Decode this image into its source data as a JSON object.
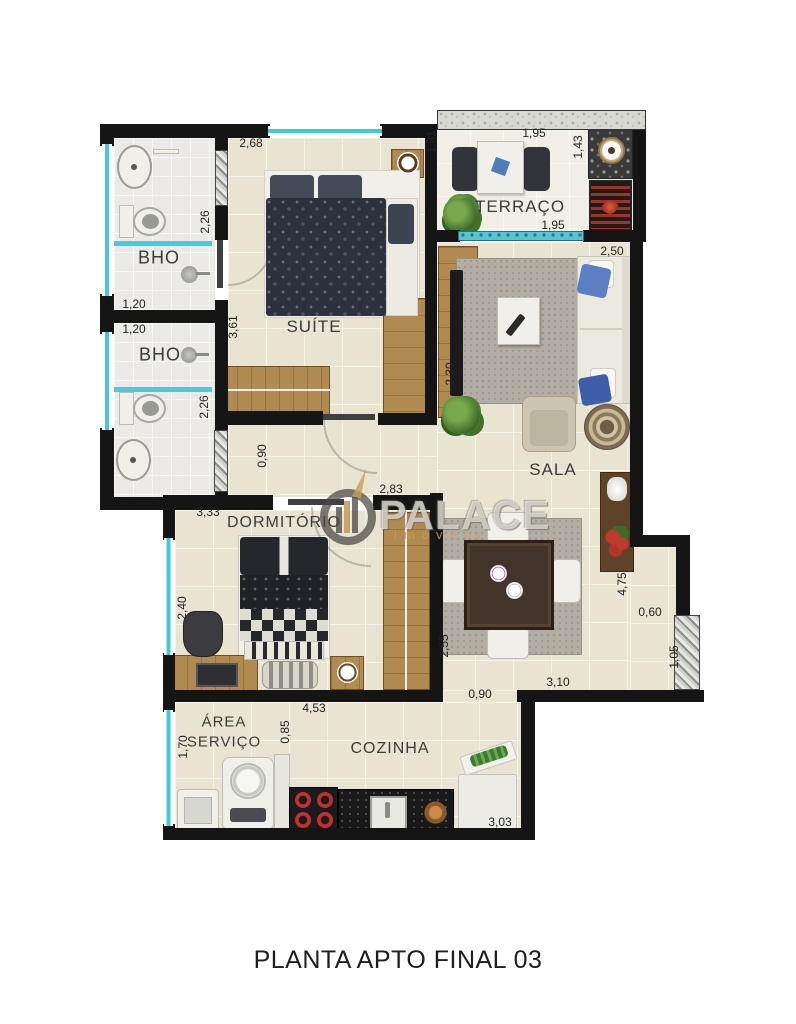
{
  "title": "PLANTA APTO FINAL 03",
  "watermark": {
    "brand": "PALACE",
    "subtitle": "imóveis"
  },
  "rooms": {
    "bho1": "BHO",
    "bho2": "BHO",
    "suite": "SUÍTE",
    "terraco": "TERRAÇO",
    "sala": "SALA",
    "dormitorio": "DORMITÓRIO",
    "area_servico_line1": "ÁREA",
    "area_servico_line2": "SERVIÇO",
    "cozinha": "COZINHA"
  },
  "dimensions": [
    "2,68",
    "2,26",
    "1,20",
    "1,20",
    "2,26",
    "3,61",
    "1,95",
    "1,31",
    "1,43",
    "1,95",
    "2,50",
    "2,30",
    "0,90",
    "3,33",
    "2,83",
    "2,40",
    "2,55",
    "4,75",
    "0,60",
    "1,05",
    "3,10",
    "0,90",
    "4,53",
    "1,70",
    "0,85",
    "3,03"
  ],
  "colors": {
    "wall": "#151515",
    "floor": "#e9e4d2",
    "bath_floor": "#ebeae6",
    "terrace_floor": "#f0eee5",
    "window": "#45c8d6",
    "wood": "#b18a52",
    "accent_red": "#b93030",
    "pillow_blue": "#5b7fc4"
  }
}
